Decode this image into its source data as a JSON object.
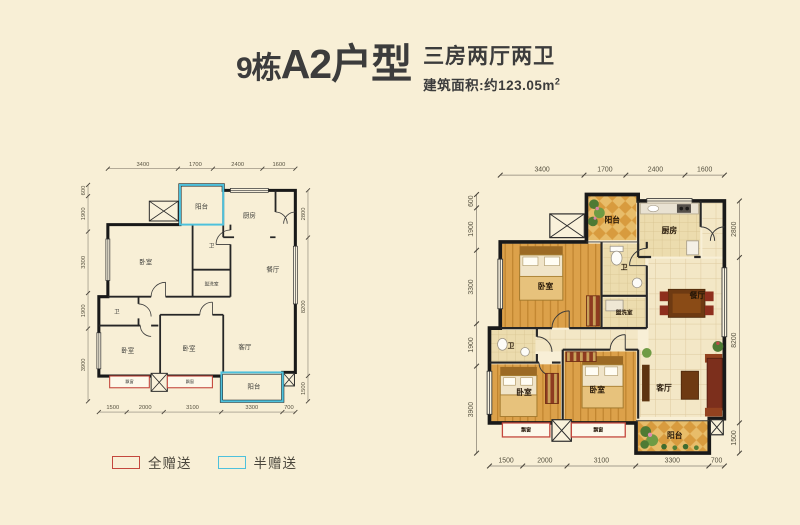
{
  "page": {
    "background": "#f8efd6"
  },
  "header": {
    "building": "9栋",
    "unit": "A2户型",
    "layout_desc": "三房两厅两卫",
    "area_text": "建筑面积:约123.05m",
    "area_sup": "2"
  },
  "legend": {
    "full": {
      "label": "全赠送",
      "color": "#c4473d"
    },
    "half": {
      "label": "半赠送",
      "color": "#4ec1dc"
    }
  },
  "floorplan": {
    "dims": {
      "top": [
        3400,
        1700,
        2400,
        1600
      ],
      "bottom": [
        1500,
        2000,
        3100,
        3300,
        700
      ],
      "left": [
        600,
        1900,
        3300,
        1900,
        3900
      ],
      "right": [
        2800,
        8200,
        1500
      ]
    },
    "rooms": [
      {
        "id": "balcony-top",
        "label": "阳台",
        "x": 114,
        "y": 30
      },
      {
        "id": "kitchen",
        "label": "厨房",
        "x": 167,
        "y": 40
      },
      {
        "id": "bedroom-master",
        "label": "卧室",
        "x": 52,
        "y": 92
      },
      {
        "id": "bath-upper",
        "label": "卫",
        "x": 125,
        "y": 74
      },
      {
        "id": "washroom",
        "label": "盥洗室",
        "x": 125,
        "y": 116
      },
      {
        "id": "dining",
        "label": "餐厅",
        "x": 193,
        "y": 100
      },
      {
        "id": "bath-lower",
        "label": "卫",
        "x": 20,
        "y": 147
      },
      {
        "id": "bedroom-2",
        "label": "卧室",
        "x": 32,
        "y": 190
      },
      {
        "id": "bedroom-3",
        "label": "卧室",
        "x": 100,
        "y": 188
      },
      {
        "id": "living",
        "label": "客厅",
        "x": 162,
        "y": 186
      },
      {
        "id": "balcony-bottom",
        "label": "阳台",
        "x": 172,
        "y": 230
      },
      {
        "id": "bay-window-1",
        "label": "飘窗",
        "x": 34,
        "y": 224.5
      },
      {
        "id": "bay-window-2",
        "label": "飘窗",
        "x": 101,
        "y": 224.5
      }
    ]
  }
}
